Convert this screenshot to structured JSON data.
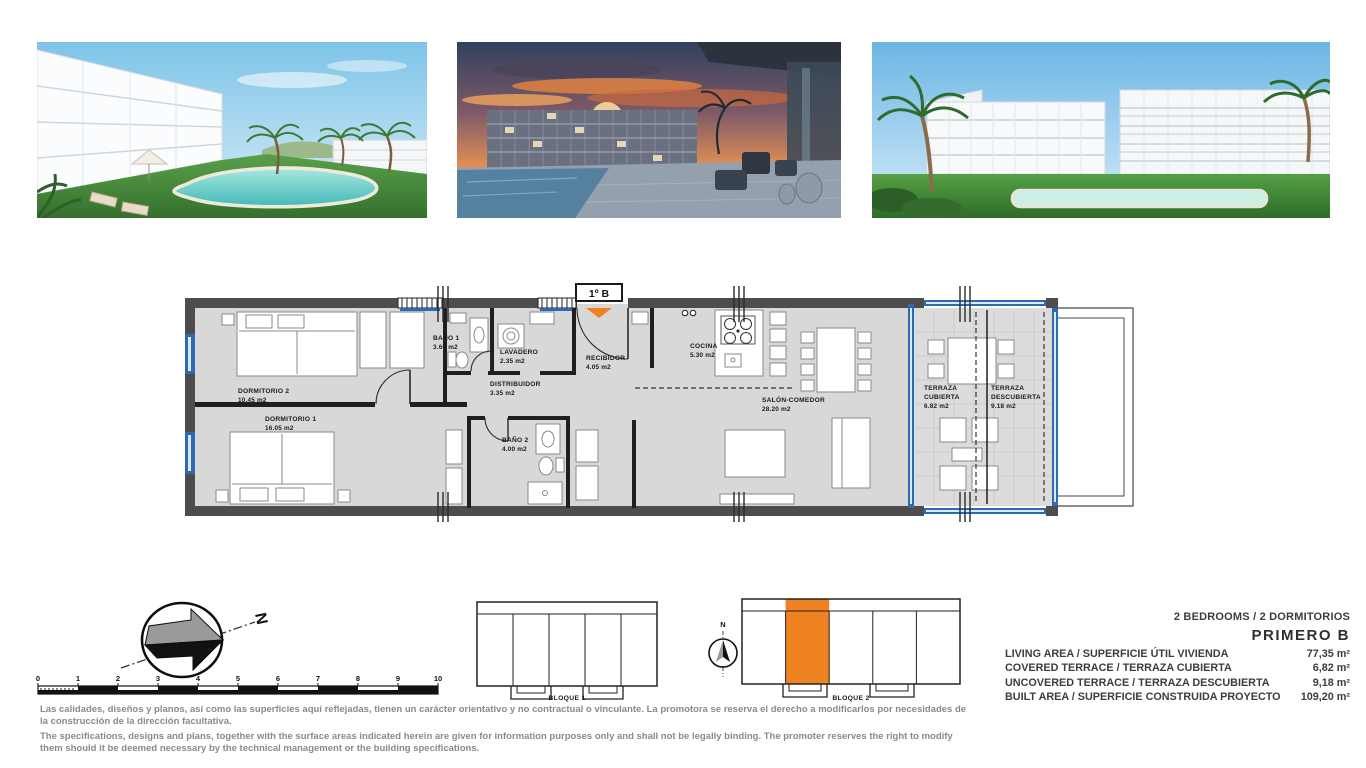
{
  "unit": {
    "label": "1º B"
  },
  "plan": {
    "rooms": [
      {
        "name": "DORMITORIO 2",
        "area": "10.45 m2"
      },
      {
        "name": "DORMITORIO 1",
        "area": "16.05 m2"
      },
      {
        "name": "BAÑO 1",
        "area": "3.60 m2"
      },
      {
        "name": "LAVADERO",
        "area": "2.35 m2"
      },
      {
        "name": "RECIBIDOR",
        "area": "4.05 m2"
      },
      {
        "name": "DISTRIBUIDOR",
        "area": "3.35 m2"
      },
      {
        "name": "COCINA",
        "area": "5.30 m2"
      },
      {
        "name": "BAÑO 2",
        "area": "4.00 m2"
      },
      {
        "name": "SALÓN-COMEDOR",
        "area": "28.20 m2"
      },
      {
        "name": "TERRAZA",
        "name2": "CUBIERTA",
        "area": "6.82 m2"
      },
      {
        "name": "TERRAZA",
        "name2": "DESCUBIERTA",
        "area": "9.18 m2"
      }
    ]
  },
  "compass": {
    "north": "N"
  },
  "block_compass": {
    "north": "N"
  },
  "scale": {
    "ticks": [
      "0",
      "1",
      "2",
      "3",
      "4",
      "5",
      "6",
      "7",
      "8",
      "9",
      "10"
    ]
  },
  "blocks": [
    {
      "label": "BLOQUE 1"
    },
    {
      "label": "BLOQUE 2"
    }
  ],
  "summary": {
    "bedrooms": "2 BEDROOMS / 2 DORMITORIOS",
    "unit_name": "PRIMERO B",
    "rows": [
      {
        "label": "LIVING AREA / SUPERFICIE ÚTIL VIVIENDA",
        "value": "77,35 m²"
      },
      {
        "label": "COVERED TERRACE / TERRAZA CUBIERTA",
        "value": "6,82 m²"
      },
      {
        "label": "UNCOVERED TERRACE / TERRAZA DESCUBIERTA",
        "value": "9,18 m²"
      },
      {
        "label": "BUILT AREA / SUPERFICIE CONSTRUIDA PROYECTO",
        "value": "109,20 m²"
      }
    ]
  },
  "disclaimer": {
    "es": "Las calidades, diseños y planos, así como las superficies aquí reflejadas, tienen un carácter orientativo y no contractual o vinculante. La promotora se reserva el derecho a modificarlos por necesidades de la construcción de la dirección facultativa.",
    "en": "The specifications, designs and plans, together with the surface areas indicated herein are given for information purposes only and shall not be legally binding. The promoter reserves the right to modify them should it be deemed necessary by the technical management or the building specifications."
  },
  "colors": {
    "accent_orange": "#EF8221",
    "wall_gray": "#4D4D4D",
    "floor_gray": "#D8D8D8",
    "window_blue": "#2E6AB2",
    "disclaimer_gray": "#8A8A8A"
  }
}
